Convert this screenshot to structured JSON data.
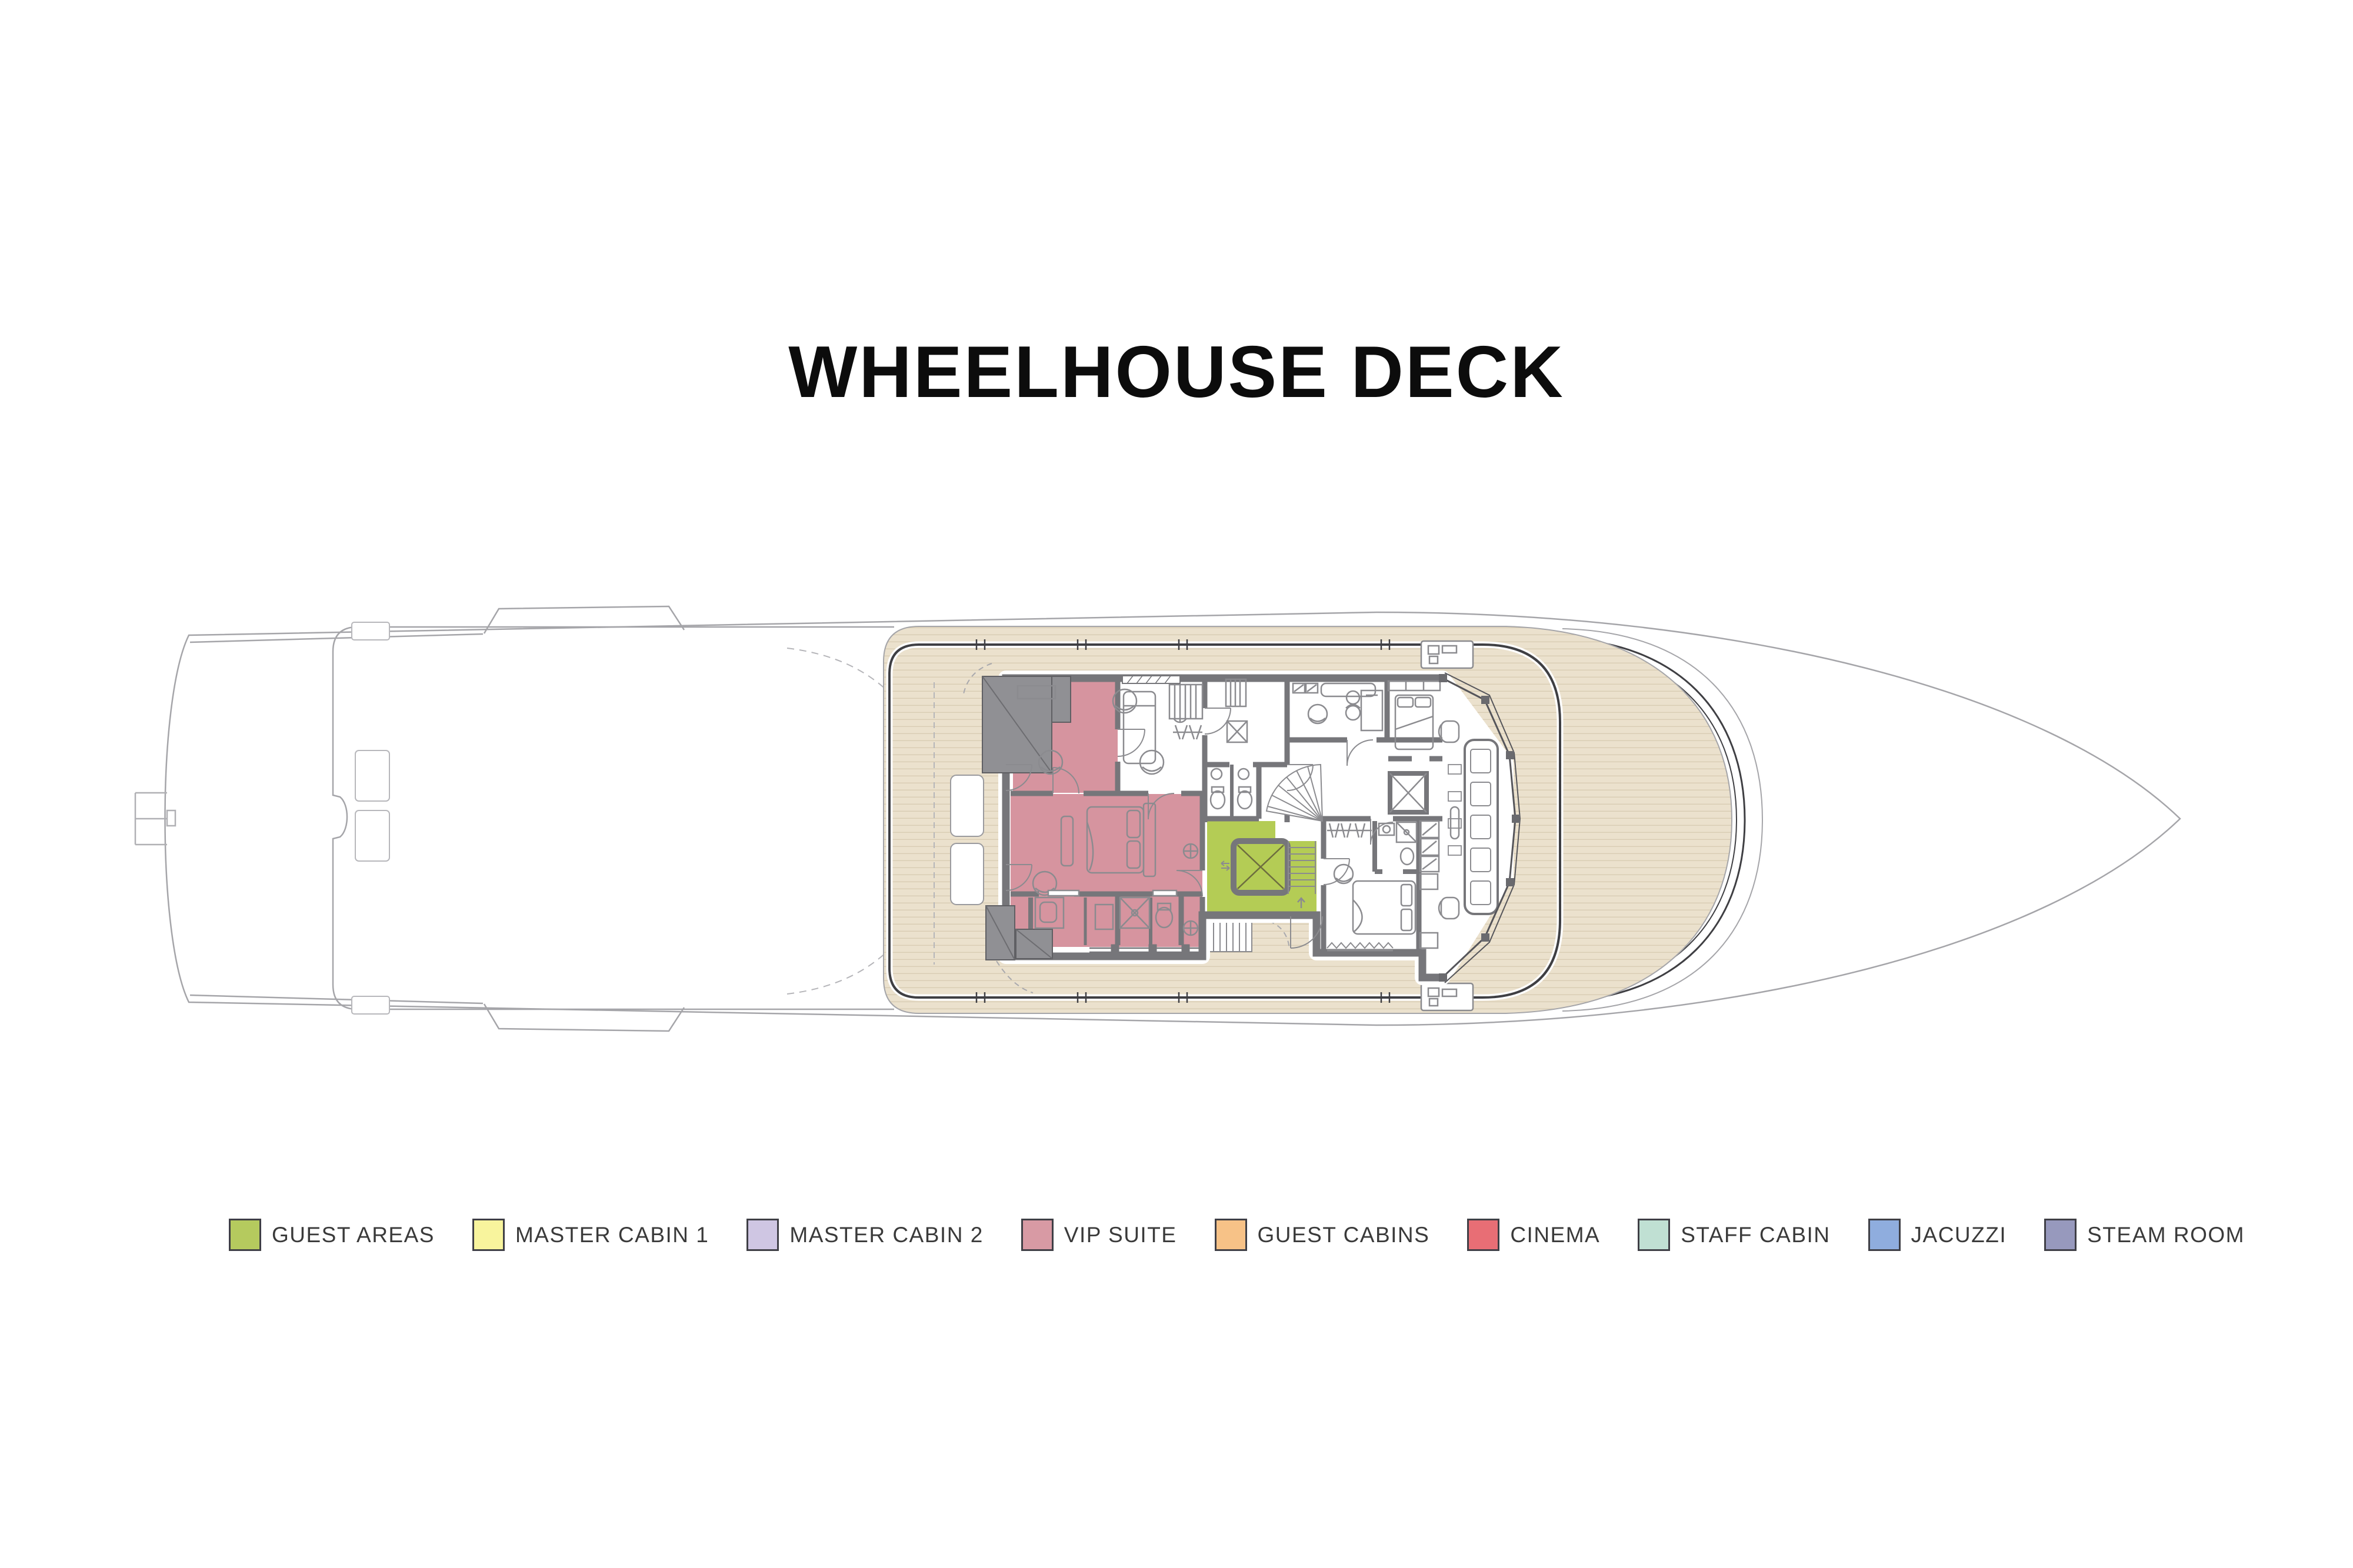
{
  "title": "WHEELHOUSE DECK",
  "legend": [
    {
      "label": "GUEST AREAS",
      "color": "#b5ca5e"
    },
    {
      "label": "MASTER CABIN 1",
      "color": "#f8f49d"
    },
    {
      "label": "MASTER CABIN 2",
      "color": "#cfc6e3"
    },
    {
      "label": "VIP SUITE",
      "color": "#d89aa4"
    },
    {
      "label": "GUEST CABINS",
      "color": "#f7c287"
    },
    {
      "label": "CINEMA",
      "color": "#e86e75"
    },
    {
      "label": "STAFF CABIN",
      "color": "#c0e0d3"
    },
    {
      "label": "JACUZZI",
      "color": "#8fadde"
    },
    {
      "label": "STEAM ROOM",
      "color": "#9799bd"
    }
  ],
  "plan": {
    "colors": {
      "vip_suite": "#d6949f",
      "guest_areas": "#b4cc55",
      "deck": "#ebe1cd",
      "plank": "#d8ccb3",
      "hull_line": "#a5a5a9",
      "dark_line": "#3f3f43",
      "wall": "#76767a",
      "fixture": "#8b8b8f",
      "box": "#909094"
    }
  }
}
